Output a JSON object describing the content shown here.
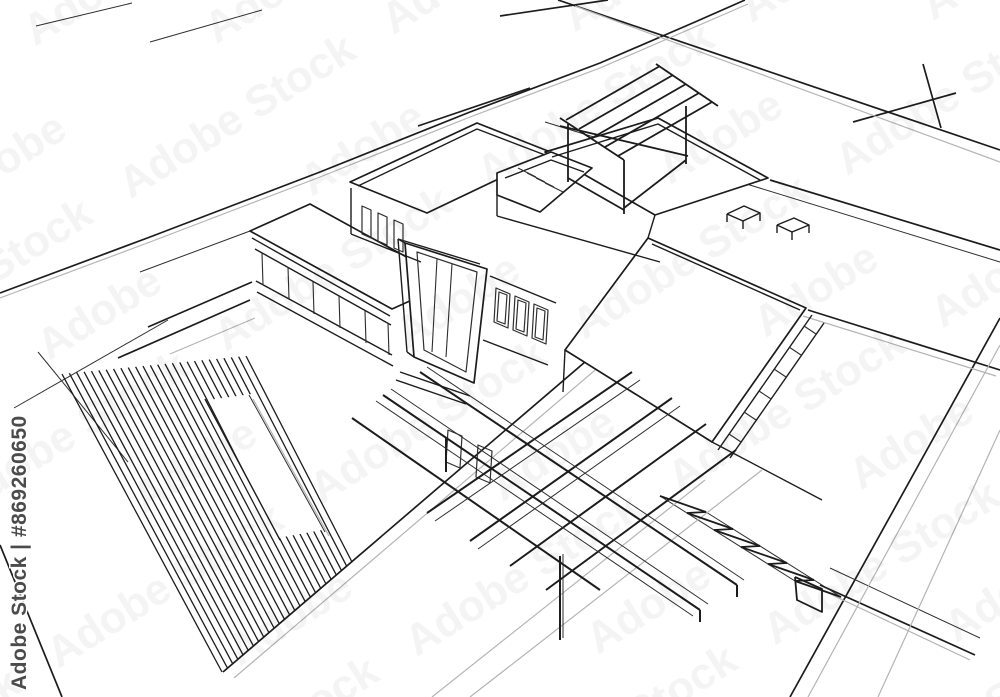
{
  "watermark": {
    "tile_text": "Adobe Stock",
    "side_text": "Adobe Stock | #869260650"
  },
  "palette": {
    "ink": "#1c1c1c",
    "thin": "#2e2e2e",
    "gray": "#b4b4b4",
    "white": "#ffffff",
    "wm_tile": "#000000",
    "wm_side": "#4b4b4b"
  },
  "canvas": {
    "width": 1000,
    "height": 697
  },
  "drawing": {
    "subject": "modern house 3d line sketch with terraces, pergola, stairs and striped deck",
    "layers": [
      {
        "name": "ground-ink",
        "stroke": "ink",
        "width": 1.7,
        "polylines": [
          [
            0,
            293,
            150,
            237,
            320,
            172,
            470,
            112,
            600,
            63,
            695,
            22,
            745,
            0
          ],
          [
            418,
            126,
            530,
            88
          ],
          [
            558,
            0,
            1000,
            150
          ],
          [
            500,
            16,
            608,
            0
          ],
          [
            853,
            122,
            956,
            93
          ],
          [
            923,
            64,
            941,
            128
          ],
          [
            770,
            180,
            1000,
            250
          ],
          [
            1000,
            318,
            790,
            697
          ],
          [
            820,
            585,
            975,
            655
          ],
          [
            0,
            545,
            62,
            697
          ],
          [
            620,
            332,
            223,
            672
          ],
          [
            252,
            282,
            148,
            327
          ],
          [
            250,
            300,
            118,
            358
          ],
          [
            808,
            310,
            1000,
            370
          ]
        ]
      },
      {
        "name": "ground-thin",
        "stroke": "thin",
        "width": 1,
        "polylines": [
          [
            36,
            26,
            132,
            3
          ],
          [
            150,
            42,
            262,
            10
          ],
          [
            14,
            408,
            168,
            320
          ],
          [
            38,
            352,
            128,
            462
          ],
          [
            830,
            568,
            980,
            638
          ],
          [
            545,
            122,
            1000,
            262
          ],
          [
            250,
            231,
            140,
            272
          ],
          [
            660,
            496,
            795,
            581
          ],
          [
            706,
            512,
            841,
            597
          ]
        ]
      },
      {
        "name": "ground-gray",
        "stroke": "gray",
        "width": 1.2,
        "polylines": [
          [
            575,
            6,
            1000,
            162
          ],
          [
            628,
            342,
            234,
            678
          ],
          [
            803,
            316,
            996,
            376
          ],
          [
            1000,
            430,
            878,
            697
          ],
          [
            432,
            697,
            705,
            480
          ],
          [
            470,
            697,
            762,
            470
          ],
          [
            255,
            318,
            170,
            354
          ],
          [
            826,
            592,
            970,
            660
          ],
          [
            1000,
            345,
            808,
            697
          ],
          [
            0,
            298,
            150,
            242,
            320,
            177,
            470,
            117,
            600,
            68,
            748,
            4
          ]
        ]
      },
      {
        "name": "deck-hatch",
        "stroke": "ink",
        "width": 1.3,
        "hatch": {
          "ax": 62,
          "ay": 374,
          "bx": 246,
          "by": 356,
          "ex": 222,
          "ey": 672,
          "fx": 352,
          "fy": 562,
          "count": 26
        }
      },
      {
        "name": "deck-path",
        "stroke": "",
        "width": 0,
        "fill": "white",
        "closed": true,
        "polylines": [
          [
            208,
            400,
            252,
            394,
            322,
            530,
            278,
            538
          ]
        ]
      },
      {
        "name": "deck-path-edges",
        "stroke": "ink",
        "width": 1.4,
        "polylines": [
          [
            205,
            399,
            280,
            540
          ]
        ]
      },
      {
        "name": "deck-path-edges-thin",
        "stroke": "thin",
        "width": 1,
        "polylines": [
          [
            249,
            395,
            325,
            532
          ]
        ]
      },
      {
        "name": "deck-path-edges-gray",
        "stroke": "gray",
        "width": 1.2,
        "polylines": [
          [
            253,
            399,
            329,
            536
          ]
        ]
      },
      {
        "name": "house-roofs",
        "stroke": "ink",
        "width": 1.7,
        "fill": "white",
        "closed": true,
        "polylines": [
          [
            250,
            231,
            392,
            309,
            452,
            282,
            310,
            204
          ],
          [
            350,
            182,
            477,
            123,
            553,
            153,
            427,
            213
          ],
          [
            545,
            152,
            658,
            118,
            768,
            178,
            655,
            215
          ],
          [
            648,
            238,
            806,
            308,
            712,
            442,
            565,
            350
          ],
          [
            497,
            173,
            551,
            152,
            592,
            168,
            540,
            212,
            497,
            195
          ],
          [
            405,
            243,
            487,
            269,
            474,
            383,
            414,
            357
          ]
        ]
      },
      {
        "name": "house-lines",
        "stroke": "ink",
        "width": 1.4,
        "polylines": [
          [
            351,
            188,
            351,
            234
          ],
          [
            351,
            234,
            421,
            262
          ],
          [
            358,
            186,
            477,
            129,
            545,
            155
          ],
          [
            252,
            238,
            390,
            316
          ],
          [
            255,
            249,
            391,
            325
          ],
          [
            256,
            281,
            392,
            355
          ],
          [
            257,
            292,
            393,
            366
          ],
          [
            552,
            157,
            658,
            124,
            760,
            180
          ],
          [
            652,
            244,
            800,
            310
          ],
          [
            812,
            315,
            718,
            450
          ],
          [
            824,
            323,
            730,
            458
          ],
          [
            490,
            276,
            556,
            303
          ],
          [
            483,
            340,
            548,
            365
          ],
          [
            400,
            372,
            470,
            396
          ],
          [
            396,
            380,
            466,
            404
          ],
          [
            565,
            350,
            563,
            392
          ],
          [
            712,
            442,
            822,
            500
          ],
          [
            505,
            178,
            551,
            160,
            584,
            172
          ],
          [
            497,
            195,
            497,
            216
          ],
          [
            497,
            216,
            660,
            262
          ],
          [
            655,
            215,
            648,
            238
          ],
          [
            727,
            214,
            744,
            206,
            760,
            213,
            743,
            221,
            727,
            214
          ],
          [
            727,
            214,
            727,
            222
          ],
          [
            760,
            213,
            760,
            221
          ],
          [
            743,
            221,
            743,
            229
          ],
          [
            777,
            225,
            794,
            218,
            809,
            225,
            792,
            232,
            777,
            225
          ],
          [
            777,
            225,
            777,
            233
          ],
          [
            809,
            225,
            809,
            233
          ],
          [
            792,
            232,
            792,
            240
          ],
          [
            398,
            239,
            405,
            243
          ],
          [
            398,
            239,
            407,
            352
          ],
          [
            407,
            352,
            414,
            357
          ],
          [
            398,
            239,
            480,
            264
          ]
        ]
      },
      {
        "name": "windows",
        "stroke": "thin",
        "width": 1.2,
        "closed": true,
        "polylines": [
          [
            362,
            206,
            371,
            210,
            371,
            238,
            362,
            234
          ],
          [
            378,
            213,
            387,
            217,
            387,
            245,
            378,
            241
          ],
          [
            394,
            220,
            403,
            224,
            403,
            252,
            394,
            248
          ],
          [
            496,
            288,
            510,
            294,
            508,
            328,
            494,
            322
          ],
          [
            515,
            296,
            529,
            302,
            527,
            336,
            513,
            330
          ],
          [
            534,
            304,
            548,
            310,
            546,
            344,
            532,
            338
          ],
          [
            499,
            292,
            507,
            295,
            505,
            324,
            497,
            321
          ],
          [
            518,
            300,
            526,
            303,
            524,
            332,
            516,
            329
          ],
          [
            537,
            308,
            545,
            311,
            543,
            340,
            535,
            337
          ],
          [
            448,
            430,
            462,
            436,
            460,
            468,
            446,
            462
          ],
          [
            478,
            445,
            492,
            451,
            490,
            483,
            476,
            477
          ],
          [
            417,
            252,
            477,
            272,
            466,
            372,
            424,
            350
          ]
        ]
      },
      {
        "name": "mullions",
        "stroke": "thin",
        "width": 1.1,
        "polylines": [
          [
            262,
            253,
            263,
            285
          ],
          [
            288,
            267,
            289,
            299
          ],
          [
            313,
            282,
            314,
            314
          ],
          [
            339,
            296,
            340,
            328
          ],
          [
            365,
            311,
            366,
            343
          ],
          [
            388,
            323,
            389,
            355
          ],
          [
            804,
            326,
            816,
            334
          ],
          [
            789,
            347,
            801,
            355
          ],
          [
            774,
            369,
            786,
            377
          ],
          [
            759,
            391,
            771,
            399
          ],
          [
            744,
            412,
            756,
            420
          ],
          [
            729,
            434,
            741,
            442
          ],
          [
            518,
            168,
            536,
            177
          ],
          [
            527,
            173,
            545,
            182
          ],
          [
            536,
            178,
            554,
            187
          ],
          [
            545,
            183,
            563,
            192
          ],
          [
            437,
            259,
            432,
            352
          ],
          [
            452,
            264,
            446,
            357
          ]
        ]
      },
      {
        "name": "pergola",
        "stroke": "ink",
        "width": 1.8,
        "polylines": [
          [
            660,
            66,
            566,
            120
          ],
          [
            673,
            75,
            579,
            129
          ],
          [
            686,
            84,
            592,
            138
          ],
          [
            699,
            93,
            605,
            147
          ],
          [
            712,
            102,
            618,
            156
          ],
          [
            656,
            64,
            718,
            106
          ],
          [
            560,
            118,
            624,
            160
          ],
          [
            560,
            126,
            688,
            156
          ],
          [
            568,
            124,
            568,
            182
          ],
          [
            624,
            160,
            624,
            214
          ],
          [
            686,
            106,
            686,
            164
          ],
          [
            568,
            178,
            624,
            210
          ],
          [
            686,
            160,
            624,
            208
          ]
        ]
      },
      {
        "name": "foreground-beams",
        "stroke": "ink",
        "width": 2,
        "polylines": [
          [
            383,
            395,
            700,
            610
          ],
          [
            420,
            372,
            737,
            585
          ],
          [
            352,
            418,
            600,
            590
          ],
          [
            632,
            372,
            427,
            513
          ],
          [
            672,
            398,
            470,
            541
          ],
          [
            706,
            424,
            510,
            566
          ],
          [
            736,
            450,
            546,
            590
          ],
          [
            560,
            556,
            560,
            640
          ],
          [
            446,
            438,
            446,
            472
          ],
          [
            700,
            610,
            700,
            622
          ],
          [
            737,
            585,
            737,
            597
          ]
        ]
      },
      {
        "name": "beam-echoes",
        "stroke": "thin",
        "width": 1,
        "polylines": [
          [
            376,
            401,
            693,
            616
          ],
          [
            391,
            389,
            708,
            604
          ],
          [
            427,
            367,
            744,
            580
          ],
          [
            640,
            380,
            435,
            521
          ],
          [
            680,
            406,
            478,
            549
          ],
          [
            563,
            554,
            563,
            638
          ]
        ]
      },
      {
        "name": "stairs-right",
        "stroke": "ink",
        "width": 1.8,
        "polylines": [
          [
            660,
            496,
            706,
            512
          ],
          [
            687,
            513,
            733,
            529
          ],
          [
            714,
            530,
            760,
            546
          ],
          [
            741,
            547,
            787,
            563
          ],
          [
            768,
            564,
            814,
            580
          ],
          [
            795,
            581,
            841,
            597
          ],
          [
            706,
            512,
            687,
            513
          ],
          [
            733,
            529,
            714,
            530
          ],
          [
            760,
            546,
            741,
            547
          ],
          [
            787,
            563,
            768,
            564
          ],
          [
            814,
            580,
            795,
            581
          ],
          [
            795,
            577,
            822,
            589,
            822,
            612,
            797,
            600,
            795,
            577
          ]
        ]
      }
    ]
  }
}
